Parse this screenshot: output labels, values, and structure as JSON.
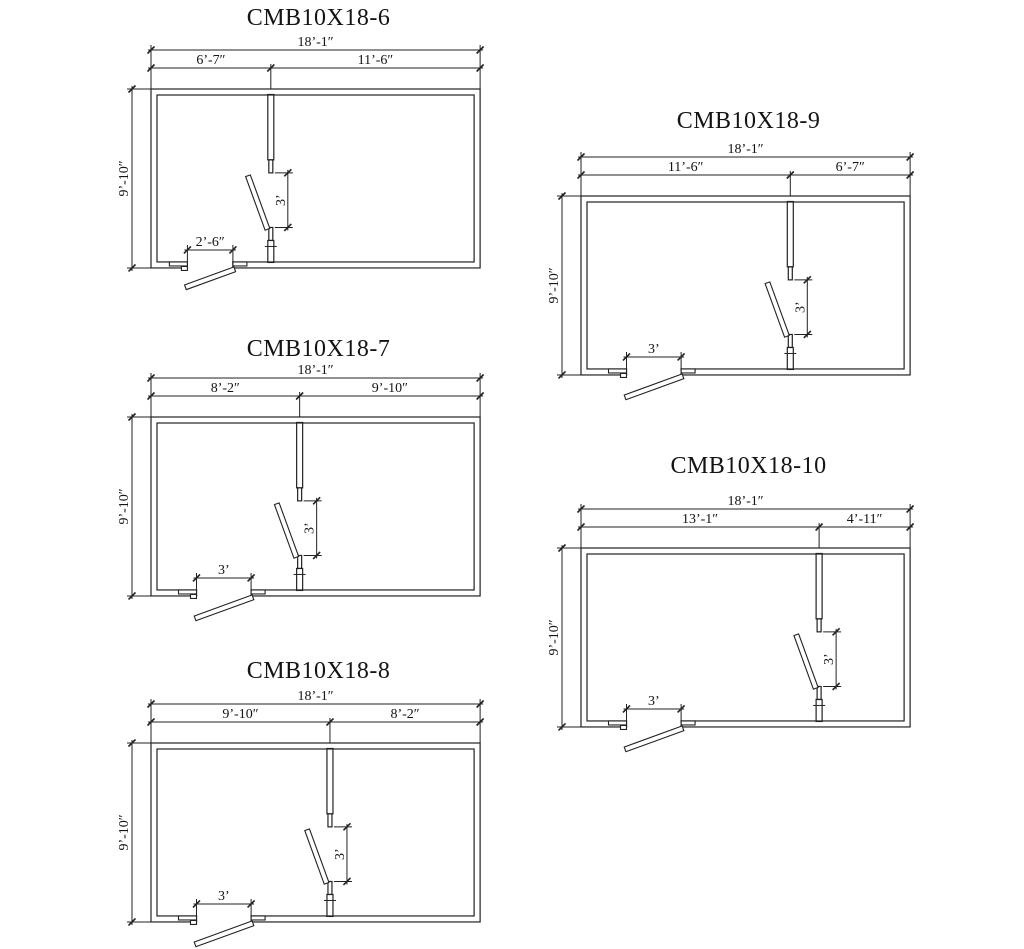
{
  "style": {
    "background": "#ffffff",
    "line_color": "#222222",
    "text_color": "#141414"
  },
  "plans": [
    {
      "title": "CMB10X18-6",
      "dims": {
        "overall_width": "18’-1″",
        "left_segment": "6’-7″",
        "right_segment": "11’-6″",
        "height": "9’-10″",
        "interior_door": "3’",
        "entry_door": "2’-6″"
      },
      "layout": {
        "x": 151,
        "y": 89,
        "title_y": 25,
        "left_ft": 6.583,
        "entry_ft": 2.5,
        "entry_offset_ft": 2.0
      }
    },
    {
      "title": "CMB10X18-7",
      "dims": {
        "overall_width": "18’-1″",
        "left_segment": "8’-2″",
        "right_segment": "9’-10″",
        "height": "9’-10″",
        "interior_door": "3’",
        "entry_door": "3’"
      },
      "layout": {
        "x": 151,
        "y": 417,
        "title_y": 356,
        "left_ft": 8.167,
        "entry_ft": 3.0,
        "entry_offset_ft": 2.5
      }
    },
    {
      "title": "CMB10X18-8",
      "dims": {
        "overall_width": "18’-1″",
        "left_segment": "9’-10″",
        "right_segment": "8’-2″",
        "height": "9’-10″",
        "interior_door": "3’",
        "entry_door": "3’"
      },
      "layout": {
        "x": 151,
        "y": 743,
        "title_y": 678,
        "left_ft": 9.833,
        "entry_ft": 3.0,
        "entry_offset_ft": 2.5
      }
    },
    {
      "title": "CMB10X18-9",
      "dims": {
        "overall_width": "18’-1″",
        "left_segment": "11’-6″",
        "right_segment": "6’-7″",
        "height": "9’-10″",
        "interior_door": "3’",
        "entry_door": "3’"
      },
      "layout": {
        "x": 581,
        "y": 196,
        "title_y": 128,
        "left_ft": 11.5,
        "entry_ft": 3.0,
        "entry_offset_ft": 2.5
      }
    },
    {
      "title": "CMB10X18-10",
      "dims": {
        "overall_width": "18’-1″",
        "left_segment": "13’-1″",
        "right_segment": "4’-11″",
        "height": "9’-10″",
        "interior_door": "3’",
        "entry_door": "3’"
      },
      "layout": {
        "x": 581,
        "y": 548,
        "title_y": 473,
        "left_ft": 13.083,
        "entry_ft": 3.0,
        "entry_offset_ft": 2.5
      }
    }
  ]
}
